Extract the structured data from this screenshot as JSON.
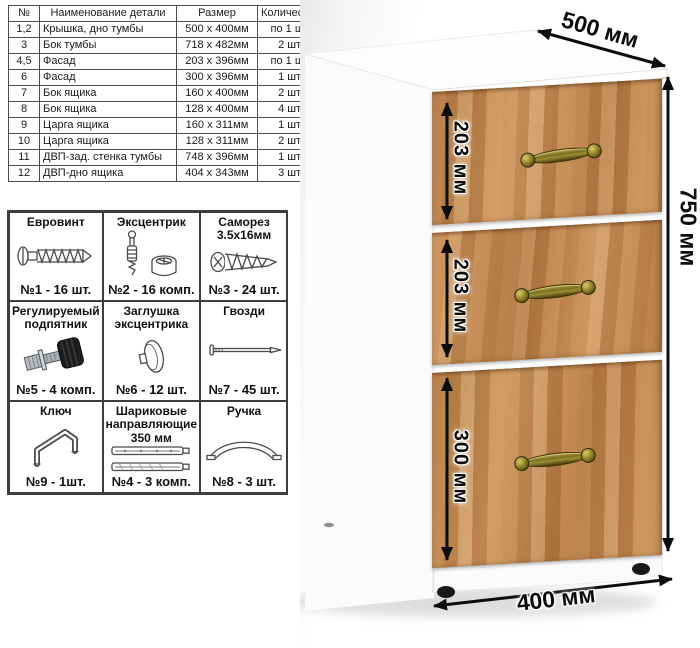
{
  "parts_table": {
    "headers": [
      "№",
      "Наименование детали",
      "Размер",
      "Количество"
    ],
    "rows": [
      {
        "num": "1,2",
        "name": "Крышка, дно тумбы",
        "size": "500 х 400мм",
        "qty": "по 1 шт."
      },
      {
        "num": "3",
        "name": "Бок тумбы",
        "size": "718 х 482мм",
        "qty": "2 шт."
      },
      {
        "num": "4,5",
        "name": "Фасад",
        "size": "203 х 396мм",
        "qty": "по 1 шт."
      },
      {
        "num": "6",
        "name": "Фасад",
        "size": "300 х 396мм",
        "qty": "1 шт."
      },
      {
        "num": "7",
        "name": "Бок ящика",
        "size": "160 х 400мм",
        "qty": "2 шт."
      },
      {
        "num": "8",
        "name": "Бок ящика",
        "size": "128 х 400мм",
        "qty": "4 шт."
      },
      {
        "num": "9",
        "name": "Царга ящика",
        "size": "160 х 311мм",
        "qty": "1 шт."
      },
      {
        "num": "10",
        "name": "Царга ящика",
        "size": "128 х 311мм",
        "qty": "2 шт."
      },
      {
        "num": "11",
        "name": "ДВП-зад. стенка тумбы",
        "size": "748 х 396мм",
        "qty": "1 шт."
      },
      {
        "num": "12",
        "name": "ДВП-дно ящика",
        "size": "404 х 343мм",
        "qty": "3 шт."
      }
    ]
  },
  "hardware": {
    "items": [
      {
        "title": "Евровинт",
        "count": "№1 - 16 шт.",
        "icon": "euro-screw-icon"
      },
      {
        "title": "Эксцентрик",
        "count": "№2 - 16 комп.",
        "icon": "eccentric-cam-icon"
      },
      {
        "title": "Саморез 3.5х16мм",
        "count": "№3 - 24 шт.",
        "icon": "self-tapping-screw-icon"
      },
      {
        "title": "Регулируемый подпятник",
        "count": "№5 - 4 комп.",
        "icon": "adjustable-foot-icon"
      },
      {
        "title": "Заглушка эксцентрика",
        "count": "№6 - 12 шт.",
        "icon": "cam-cover-icon"
      },
      {
        "title": "Гвозди",
        "count": "№7 - 45 шт.",
        "icon": "nail-icon"
      },
      {
        "title": "Ключ",
        "count": "№9 - 1шт.",
        "icon": "hex-key-icon"
      },
      {
        "title": "Шариковые направляющие 350 мм",
        "count": "№4 - 3 комп.",
        "icon": "drawer-slides-icon"
      },
      {
        "title": "Ручка",
        "count": "№8 - 3 шт.",
        "icon": "handle-icon"
      }
    ]
  },
  "cabinet": {
    "description": "three-drawer cabinet, white body with oak drawer fronts and brass handles",
    "dimensions": {
      "depth": "500 мм",
      "height": "750 мм",
      "width": "400 мм",
      "drawer1": "203 мм",
      "drawer2": "203 мм",
      "drawer3": "300 мм"
    },
    "colors": {
      "wood": "#c58a54",
      "wood_dark": "#a96f3c",
      "wood_light": "#d4a06a",
      "handle_brass": "#8f8433",
      "body_white": "#ffffff",
      "dimension_text": "#0c0c0c"
    }
  }
}
